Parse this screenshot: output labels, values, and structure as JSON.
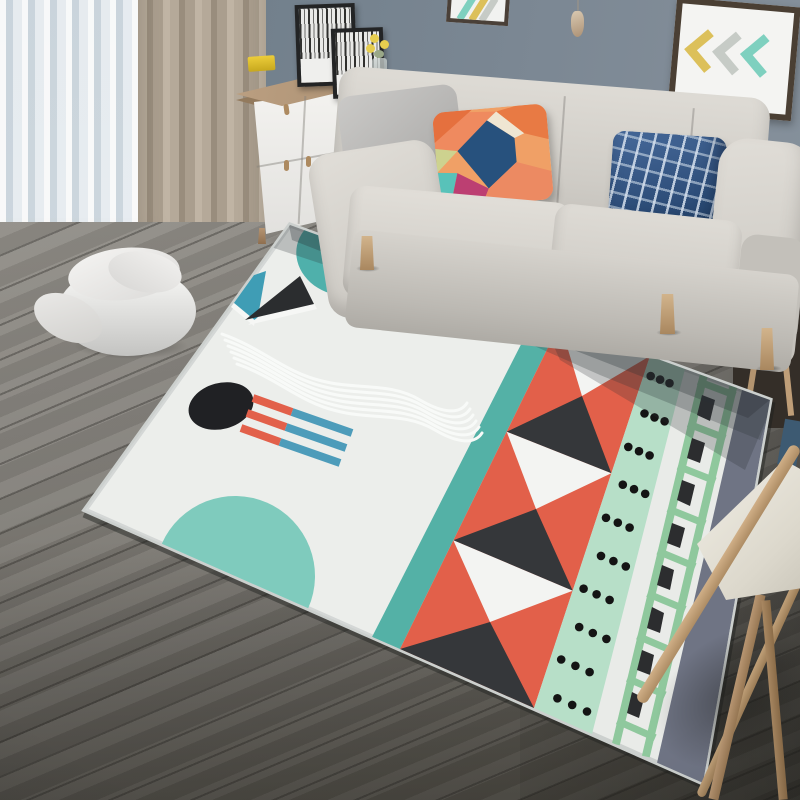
{
  "scene": {
    "label": "Scandinavian living room product photo of a geometric area rug",
    "no_visible_text": true
  },
  "palette": {
    "wall_blue_gray": "#72808c",
    "curtain_sheer": "#e3e9ee",
    "curtain_taupe": "#a99d8d",
    "cabinet_white": "#f3f2ef",
    "cabinet_oak": "#b2977a",
    "cabinet_yellow": "#efc42a",
    "sofa_fabric": "#d5d2cc",
    "floor_wood": "#7d7a74",
    "rug_base": "#e9ebe8",
    "rug_teal": "#54b1a6",
    "rug_coral": "#e2604a",
    "rug_mint": "#b7dfc8",
    "rug_ladder_green": "#8fc89d",
    "rug_slate": "#6f7484",
    "rug_black": "#232528",
    "pillow_navy": "#2c4c77",
    "wood_light": "#c0a078"
  },
  "wall": {
    "label": "blue-gray painted wall"
  },
  "wall_decor": {
    "right_frame": {
      "label": "framed chevron art",
      "chevrons": [
        "yellow",
        "gray",
        "teal"
      ],
      "frame_color": "#4a3f34"
    },
    "top_partial_frame": {
      "label": "partially cropped framed art with teal and yellow stripes"
    },
    "pendant": {
      "label": "small wooden cone pendant on string"
    }
  },
  "curtains": {
    "sheer": {
      "label": "white voile curtain"
    },
    "drape": {
      "label": "taupe curtain panel pooling on floor"
    }
  },
  "cabinet": {
    "label": "white sideboard with oak top",
    "features": [
      "yellow open cubby with dark interior and books",
      "gray drawer with knob",
      "white doors with wood handles",
      "wood legs"
    ],
    "decor": [
      "large black-framed black-and-white print",
      "small black-framed black-and-white print",
      "yellow box",
      "glass vase with yellow flowers"
    ]
  },
  "sofa": {
    "label": "light gray three-seat fabric sofa with wood legs",
    "pillows": [
      {
        "label": "gray throw pillow"
      },
      {
        "label": "multicolor geometric throw pillow",
        "colors": [
          "#e5703e",
          "#f0a066",
          "#27517d",
          "#bc3f72",
          "#58c2b9",
          "#efe6d2",
          "#cdd28f",
          "#ec8a62"
        ]
      },
      {
        "label": "navy windowpane plaid throw pillow"
      }
    ]
  },
  "pouf": {
    "label": "round white pouf with draped cloth"
  },
  "side_table": {
    "label": "wood side table in shadow behind sofa arm"
  },
  "chair": {
    "label": "wood-frame chair with white cushion, partially in frame"
  },
  "floor": {
    "label": "gray oak plank flooring laid diagonally"
  },
  "rug": {
    "label": "postmodern geometric area rug, light gray ground",
    "base_color": "#e9ebe8",
    "bands_right_to_left": [
      {
        "name": "slate gray edge band",
        "color": "#6f7484"
      },
      {
        "name": "green ladder band with black blocks",
        "colors": [
          "#8fc89d",
          "#2c2d2f"
        ]
      },
      {
        "name": "mint band with black polka dots",
        "colors": [
          "#b7dfc8",
          "#141414"
        ],
        "dot_count": 30
      },
      {
        "name": "coral band with alternating white and charcoal triangles",
        "colors": [
          "#e2604a",
          "#f3f4f2",
          "#35373a"
        ],
        "triangle_count": 6
      },
      {
        "name": "thin teal stripe",
        "color": "#54b1a6"
      }
    ],
    "field_motifs": [
      {
        "name": "two-tone circle",
        "colors": [
          "#4fb0ab",
          "#a7d9c0"
        ]
      },
      {
        "name": "coral parallelogram",
        "color": "#e2604a"
      },
      {
        "name": "steel-blue parallelogram",
        "color": "#4d9cba"
      },
      {
        "name": "teal triangle",
        "color": "#3f9db5"
      },
      {
        "name": "black triangle with white offset",
        "color": "#2b2d2f"
      },
      {
        "name": "white wavy lines",
        "count": 6
      },
      {
        "name": "black oval",
        "color": "#202124"
      },
      {
        "name": "coral and blue stripe bars",
        "count": 3,
        "colors": [
          "#e2604a",
          "#4d9cba"
        ]
      },
      {
        "name": "aqua half disc on front edge",
        "color": "#7fcbbd"
      }
    ]
  }
}
